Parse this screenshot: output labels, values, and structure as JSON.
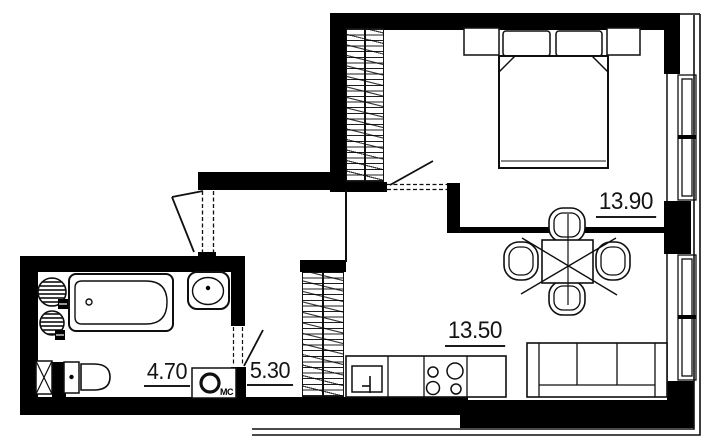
{
  "plan": {
    "rooms": [
      {
        "name": "bedroom",
        "area_label": "13.90"
      },
      {
        "name": "kitchen-living-room",
        "area_label": "13.50"
      },
      {
        "name": "hallway",
        "area_label": "5.30"
      },
      {
        "name": "bathroom",
        "area_label": "4.70"
      }
    ],
    "appliance_labels": {
      "washing_machine": "МС"
    },
    "colors": {
      "walls": "#000000",
      "lines": "#0f0f0f",
      "background": "#ffffff"
    }
  }
}
